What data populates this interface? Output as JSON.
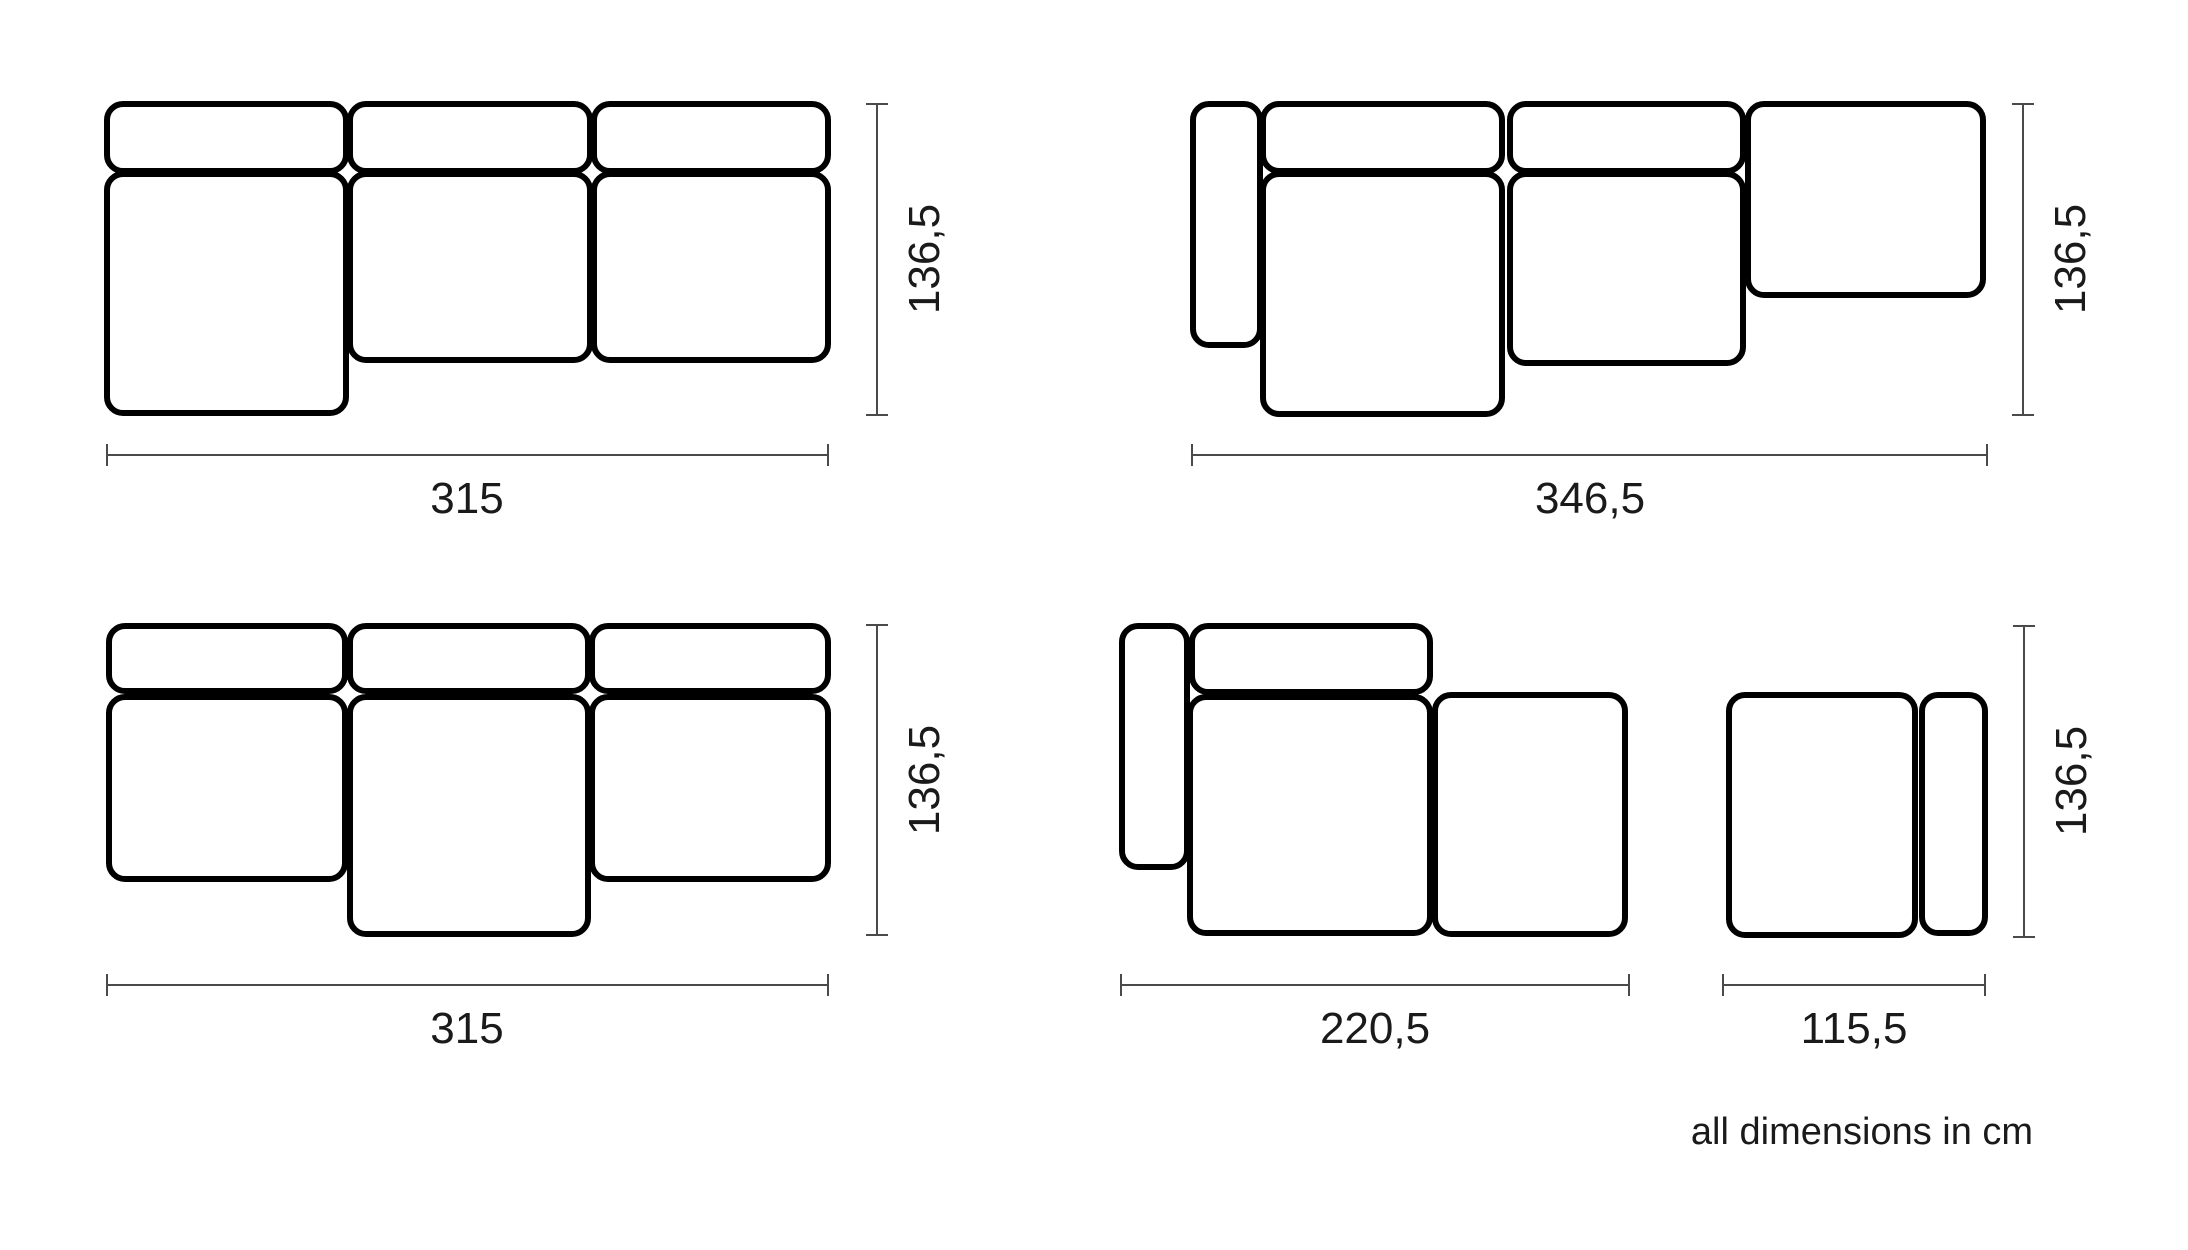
{
  "note": "all dimensions in cm",
  "units": "cm",
  "colors": {
    "background": "#ffffff",
    "outline": "#000000",
    "dim_line": "#4a4a4a",
    "label_text": "#1a1a1a"
  },
  "stroke": {
    "outline_width": 6,
    "dim_width": 2,
    "corner_radius": 16,
    "tick_half": 11
  },
  "configurations": [
    {
      "name": "config-three-seater-chaise-left",
      "width_cm": "315",
      "depth_cm": "136,5",
      "pieces": [
        {
          "type": "backrest",
          "x": 107,
          "y": 104,
          "w": 239,
          "h": 67
        },
        {
          "type": "backrest",
          "x": 350,
          "y": 104,
          "w": 240,
          "h": 67
        },
        {
          "type": "backrest",
          "x": 594,
          "y": 104,
          "w": 234,
          "h": 67
        },
        {
          "type": "chaise-seat",
          "x": 107,
          "y": 174,
          "w": 239,
          "h": 239
        },
        {
          "type": "seat",
          "x": 350,
          "y": 174,
          "w": 240,
          "h": 186
        },
        {
          "type": "seat",
          "x": 594,
          "y": 174,
          "w": 234,
          "h": 186
        }
      ],
      "h_dim": {
        "x1": 107,
        "x2": 828,
        "y": 455,
        "label": "315",
        "lx": 467,
        "ly": 513
      },
      "v_dim": {
        "x": 877,
        "y1": 104,
        "y2": 415,
        "label": "136,5",
        "lx": 939,
        "ly": 259
      }
    },
    {
      "name": "config-armrest-chaise-open-end",
      "width_cm": "346,5",
      "depth_cm": "136,5",
      "pieces": [
        {
          "type": "armrest",
          "x": 1193,
          "y": 104,
          "w": 67,
          "h": 241
        },
        {
          "type": "backrest",
          "x": 1263,
          "y": 104,
          "w": 239,
          "h": 67
        },
        {
          "type": "backrest",
          "x": 1510,
          "y": 104,
          "w": 233,
          "h": 67
        },
        {
          "type": "chaise-seat",
          "x": 1263,
          "y": 174,
          "w": 239,
          "h": 240
        },
        {
          "type": "seat",
          "x": 1510,
          "y": 174,
          "w": 233,
          "h": 189
        },
        {
          "type": "open-end-seat",
          "x": 1748,
          "y": 104,
          "w": 235,
          "h": 191
        }
      ],
      "h_dim": {
        "x1": 1192,
        "x2": 1987,
        "y": 455,
        "label": "346,5",
        "lx": 1590,
        "ly": 513
      },
      "v_dim": {
        "x": 2023,
        "y1": 104,
        "y2": 415,
        "label": "136,5",
        "lx": 2085,
        "ly": 259
      }
    },
    {
      "name": "config-three-seater-chaise-middle",
      "width_cm": "315",
      "depth_cm": "136,5",
      "pieces": [
        {
          "type": "backrest",
          "x": 109,
          "y": 626,
          "w": 236,
          "h": 65
        },
        {
          "type": "backrest",
          "x": 350,
          "y": 626,
          "w": 238,
          "h": 65
        },
        {
          "type": "backrest",
          "x": 592,
          "y": 626,
          "w": 236,
          "h": 65
        },
        {
          "type": "seat",
          "x": 109,
          "y": 697,
          "w": 236,
          "h": 182
        },
        {
          "type": "chaise-seat",
          "x": 350,
          "y": 697,
          "w": 238,
          "h": 237
        },
        {
          "type": "seat",
          "x": 592,
          "y": 697,
          "w": 236,
          "h": 182
        }
      ],
      "h_dim": {
        "x1": 107,
        "x2": 828,
        "y": 985,
        "label": "315",
        "lx": 467,
        "ly": 1043
      },
      "v_dim": {
        "x": 877,
        "y1": 625,
        "y2": 935,
        "label": "136,5",
        "lx": 939,
        "ly": 780
      }
    },
    {
      "name": "config-armrest-chaise-ottoman",
      "width_cm": "220,5",
      "depth_cm": "136,5",
      "pieces": [
        {
          "type": "armrest",
          "x": 1122,
          "y": 626,
          "w": 65,
          "h": 241
        },
        {
          "type": "backrest",
          "x": 1192,
          "y": 626,
          "w": 238,
          "h": 66
        },
        {
          "type": "chaise-seat",
          "x": 1190,
          "y": 697,
          "w": 240,
          "h": 236
        },
        {
          "type": "open-end-seat",
          "x": 1435,
          "y": 695,
          "w": 190,
          "h": 239
        }
      ],
      "h_dim": {
        "x1": 1121,
        "x2": 1629,
        "y": 985,
        "label": "220,5",
        "lx": 1375,
        "ly": 1043
      }
    },
    {
      "name": "config-ottoman-armrest-right",
      "width_cm": "115,5",
      "depth_cm": "136,5",
      "pieces": [
        {
          "type": "seat",
          "x": 1729,
          "y": 695,
          "w": 186,
          "h": 240
        },
        {
          "type": "armrest",
          "x": 1922,
          "y": 695,
          "w": 63,
          "h": 238
        }
      ],
      "h_dim": {
        "x1": 1723,
        "x2": 1985,
        "y": 985,
        "label": "115,5",
        "lx": 1854,
        "ly": 1043
      },
      "v_dim": {
        "x": 2024,
        "y1": 626,
        "y2": 937,
        "label": "136,5",
        "lx": 2086,
        "ly": 781
      }
    }
  ]
}
